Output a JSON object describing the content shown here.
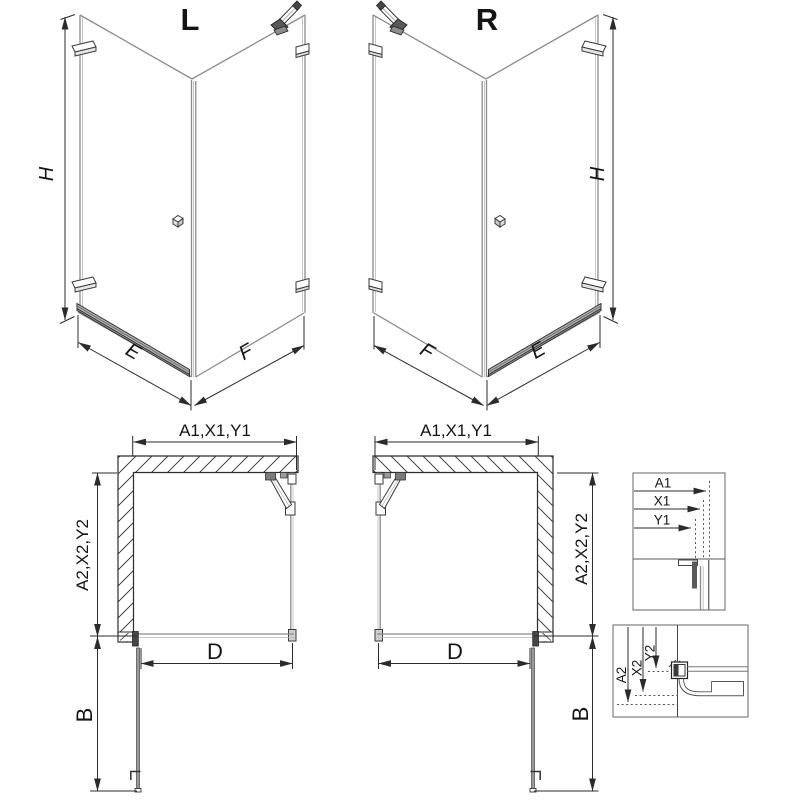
{
  "page": {
    "background": "#ffffff"
  },
  "colors": {
    "line": "#2b2b2b",
    "glass": "#8c8c8c",
    "threshold_fill": "#b3b3b3",
    "hardware_dark": "#555555",
    "text": "#141414"
  },
  "views": {
    "iso_left": {
      "title": "L",
      "height_label": "H",
      "door_width_label": "E",
      "panel_width_label": "F"
    },
    "iso_right": {
      "title": "R",
      "height_label": "H",
      "door_width_label": "E",
      "panel_width_label": "F"
    },
    "plan_left": {
      "top_dim": "A1,X1,Y1",
      "side_dim": "A2,X2,Y2",
      "opening_dim": "D",
      "door_dim": "B"
    },
    "plan_right": {
      "top_dim": "A1,X1,Y1",
      "side_dim": "A2,X2,Y2",
      "opening_dim": "D",
      "door_dim": "B"
    },
    "detail_top": {
      "labels": [
        "A1",
        "X1",
        "Y1"
      ]
    },
    "detail_bottom": {
      "labels": [
        "A2",
        "X2",
        "Y2"
      ]
    }
  }
}
